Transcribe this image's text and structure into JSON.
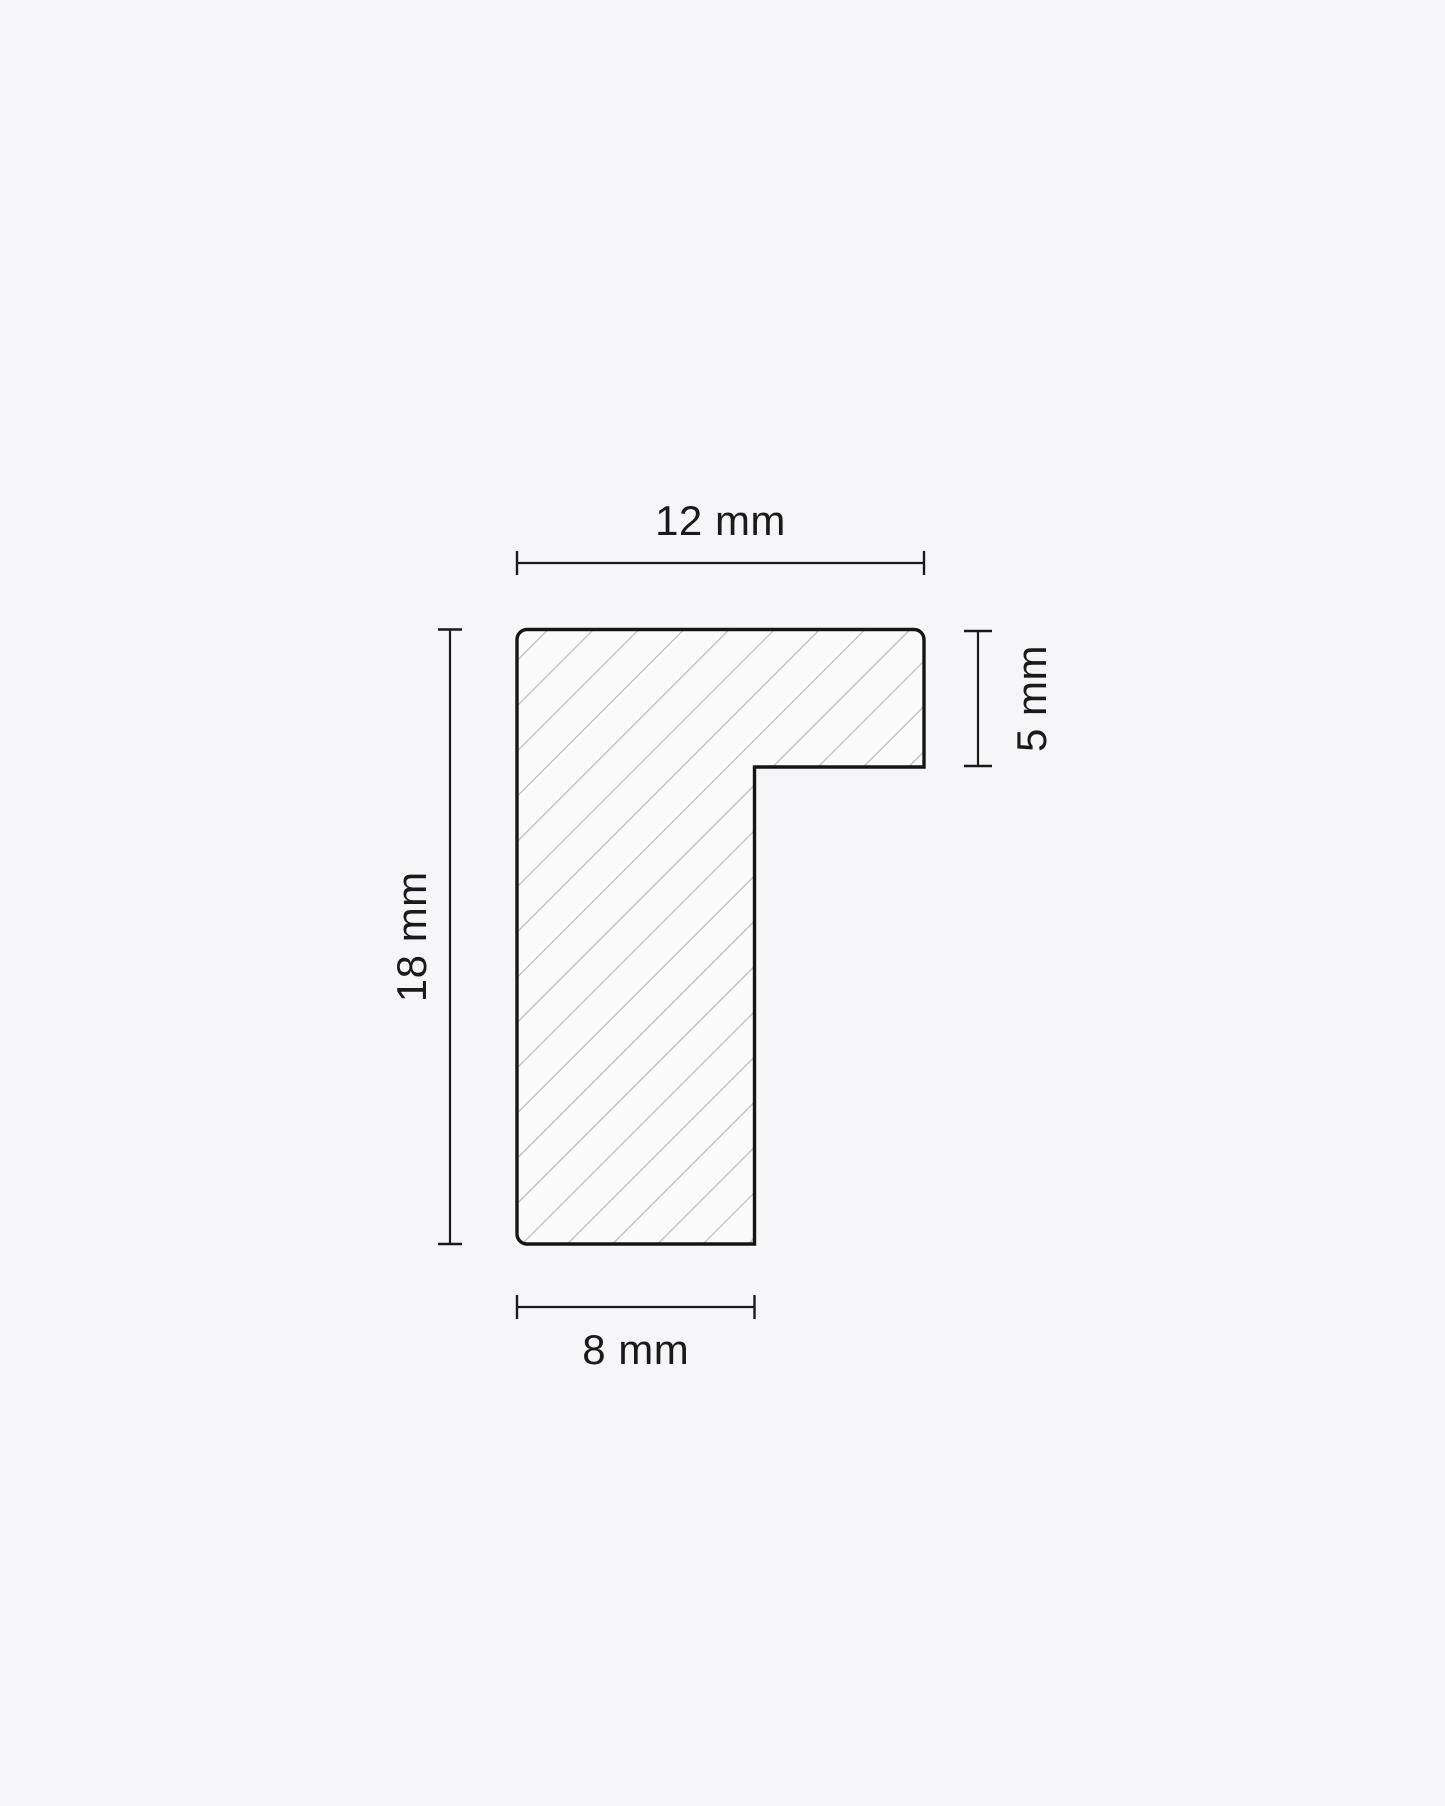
{
  "diagram": {
    "labels": {
      "top": "12 mm",
      "right": "5 mm",
      "left": "18 mm",
      "bottom": "8 mm"
    },
    "colors": {
      "background": "#f6f6f8",
      "shape_fill": "#fbfbfc",
      "hatch_line": "#c6c6ca",
      "outline": "#151515",
      "dimension_line": "#1a1a1a",
      "label_text": "#1a1a1a"
    }
  }
}
